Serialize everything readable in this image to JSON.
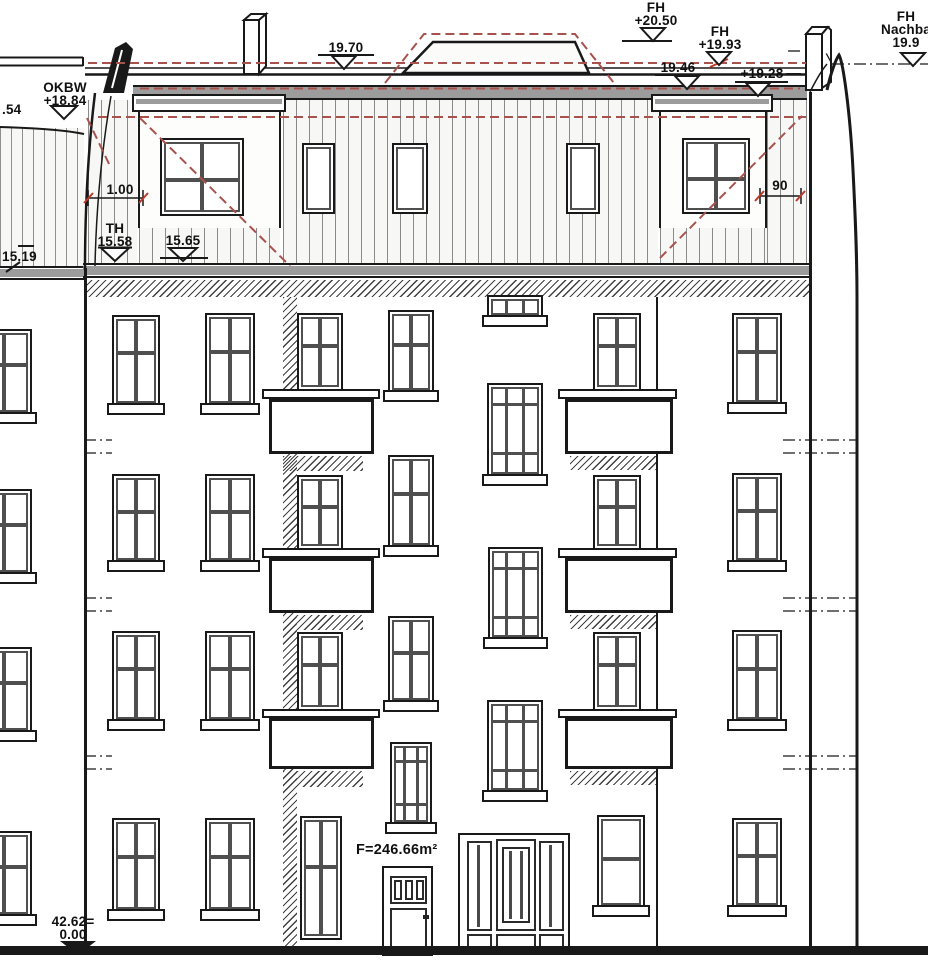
{
  "drawing": {
    "kind": "building front elevation",
    "area_label": "F=246.66m²",
    "levels": {
      "fh_top": {
        "l1": "FH",
        "l2": "+20.50"
      },
      "fh_ridge": {
        "l1": "FH",
        "l2": "+19.93"
      },
      "roof_left": {
        "l1": "19.70"
      },
      "roof_mid": {
        "l1": "19.46"
      },
      "roof_right": {
        "l1": "+19.28"
      },
      "fh_neighbor": {
        "l1": "FH",
        "l2": "Nachba",
        "l3": "19.9"
      },
      "okbw": {
        "l1": "OKBW",
        "l2": "+18.84"
      },
      "left_cut": {
        "l1": ".54"
      },
      "th": {
        "l1": "TH",
        "l2": "15.58"
      },
      "terrace": {
        "l1": "15.65"
      },
      "neighbor_left": {
        "l1": "15.19"
      },
      "ground": {
        "l1": "42.62=",
        "l2": "0.00"
      }
    },
    "dimensions": {
      "dormer_offset_left": "1.00",
      "dormer_offset_right": "90"
    }
  }
}
